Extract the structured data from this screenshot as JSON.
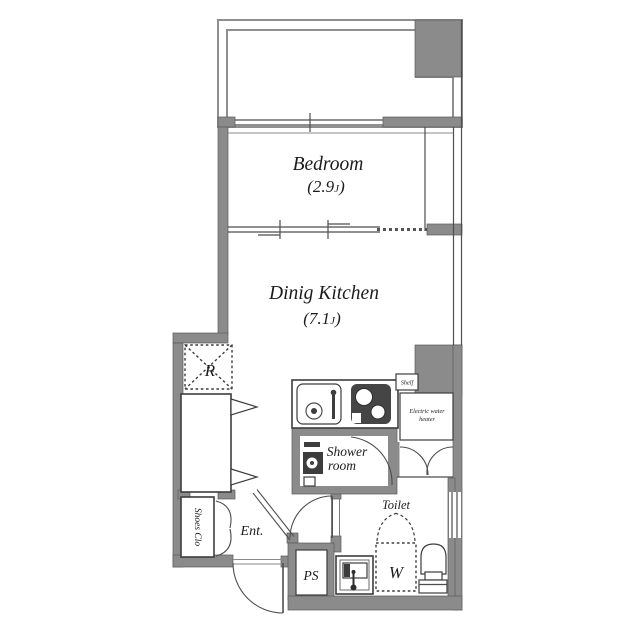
{
  "plan": {
    "rooms": {
      "bedroom": {
        "name": "Bedroom",
        "size_prefix": "(2.9",
        "size_unit": "J",
        "size_suffix": ")"
      },
      "dining_kitchen": {
        "name": "Dinig Kitchen",
        "size_prefix": "(7.1",
        "size_unit": "J",
        "size_suffix": ")"
      },
      "shower_room": {
        "line1": "Shower",
        "line2": "room"
      },
      "toilet": {
        "name": "Toilet"
      },
      "entrance": {
        "name": "Ent."
      },
      "shoes_closet": {
        "name": "Shoes Clo"
      }
    },
    "fixtures": {
      "refrigerator": "R",
      "washing_machine": "W",
      "pipe_space": "PS",
      "shelf": "Shelf",
      "water_heater_line1": "Electric water",
      "water_heater_line2": "heater"
    },
    "colors": {
      "wall": "#8b8b8b",
      "outline": "#4e4e4e",
      "stove": "#454545",
      "text": "#1c1c1c",
      "background": "#ffffff"
    }
  }
}
